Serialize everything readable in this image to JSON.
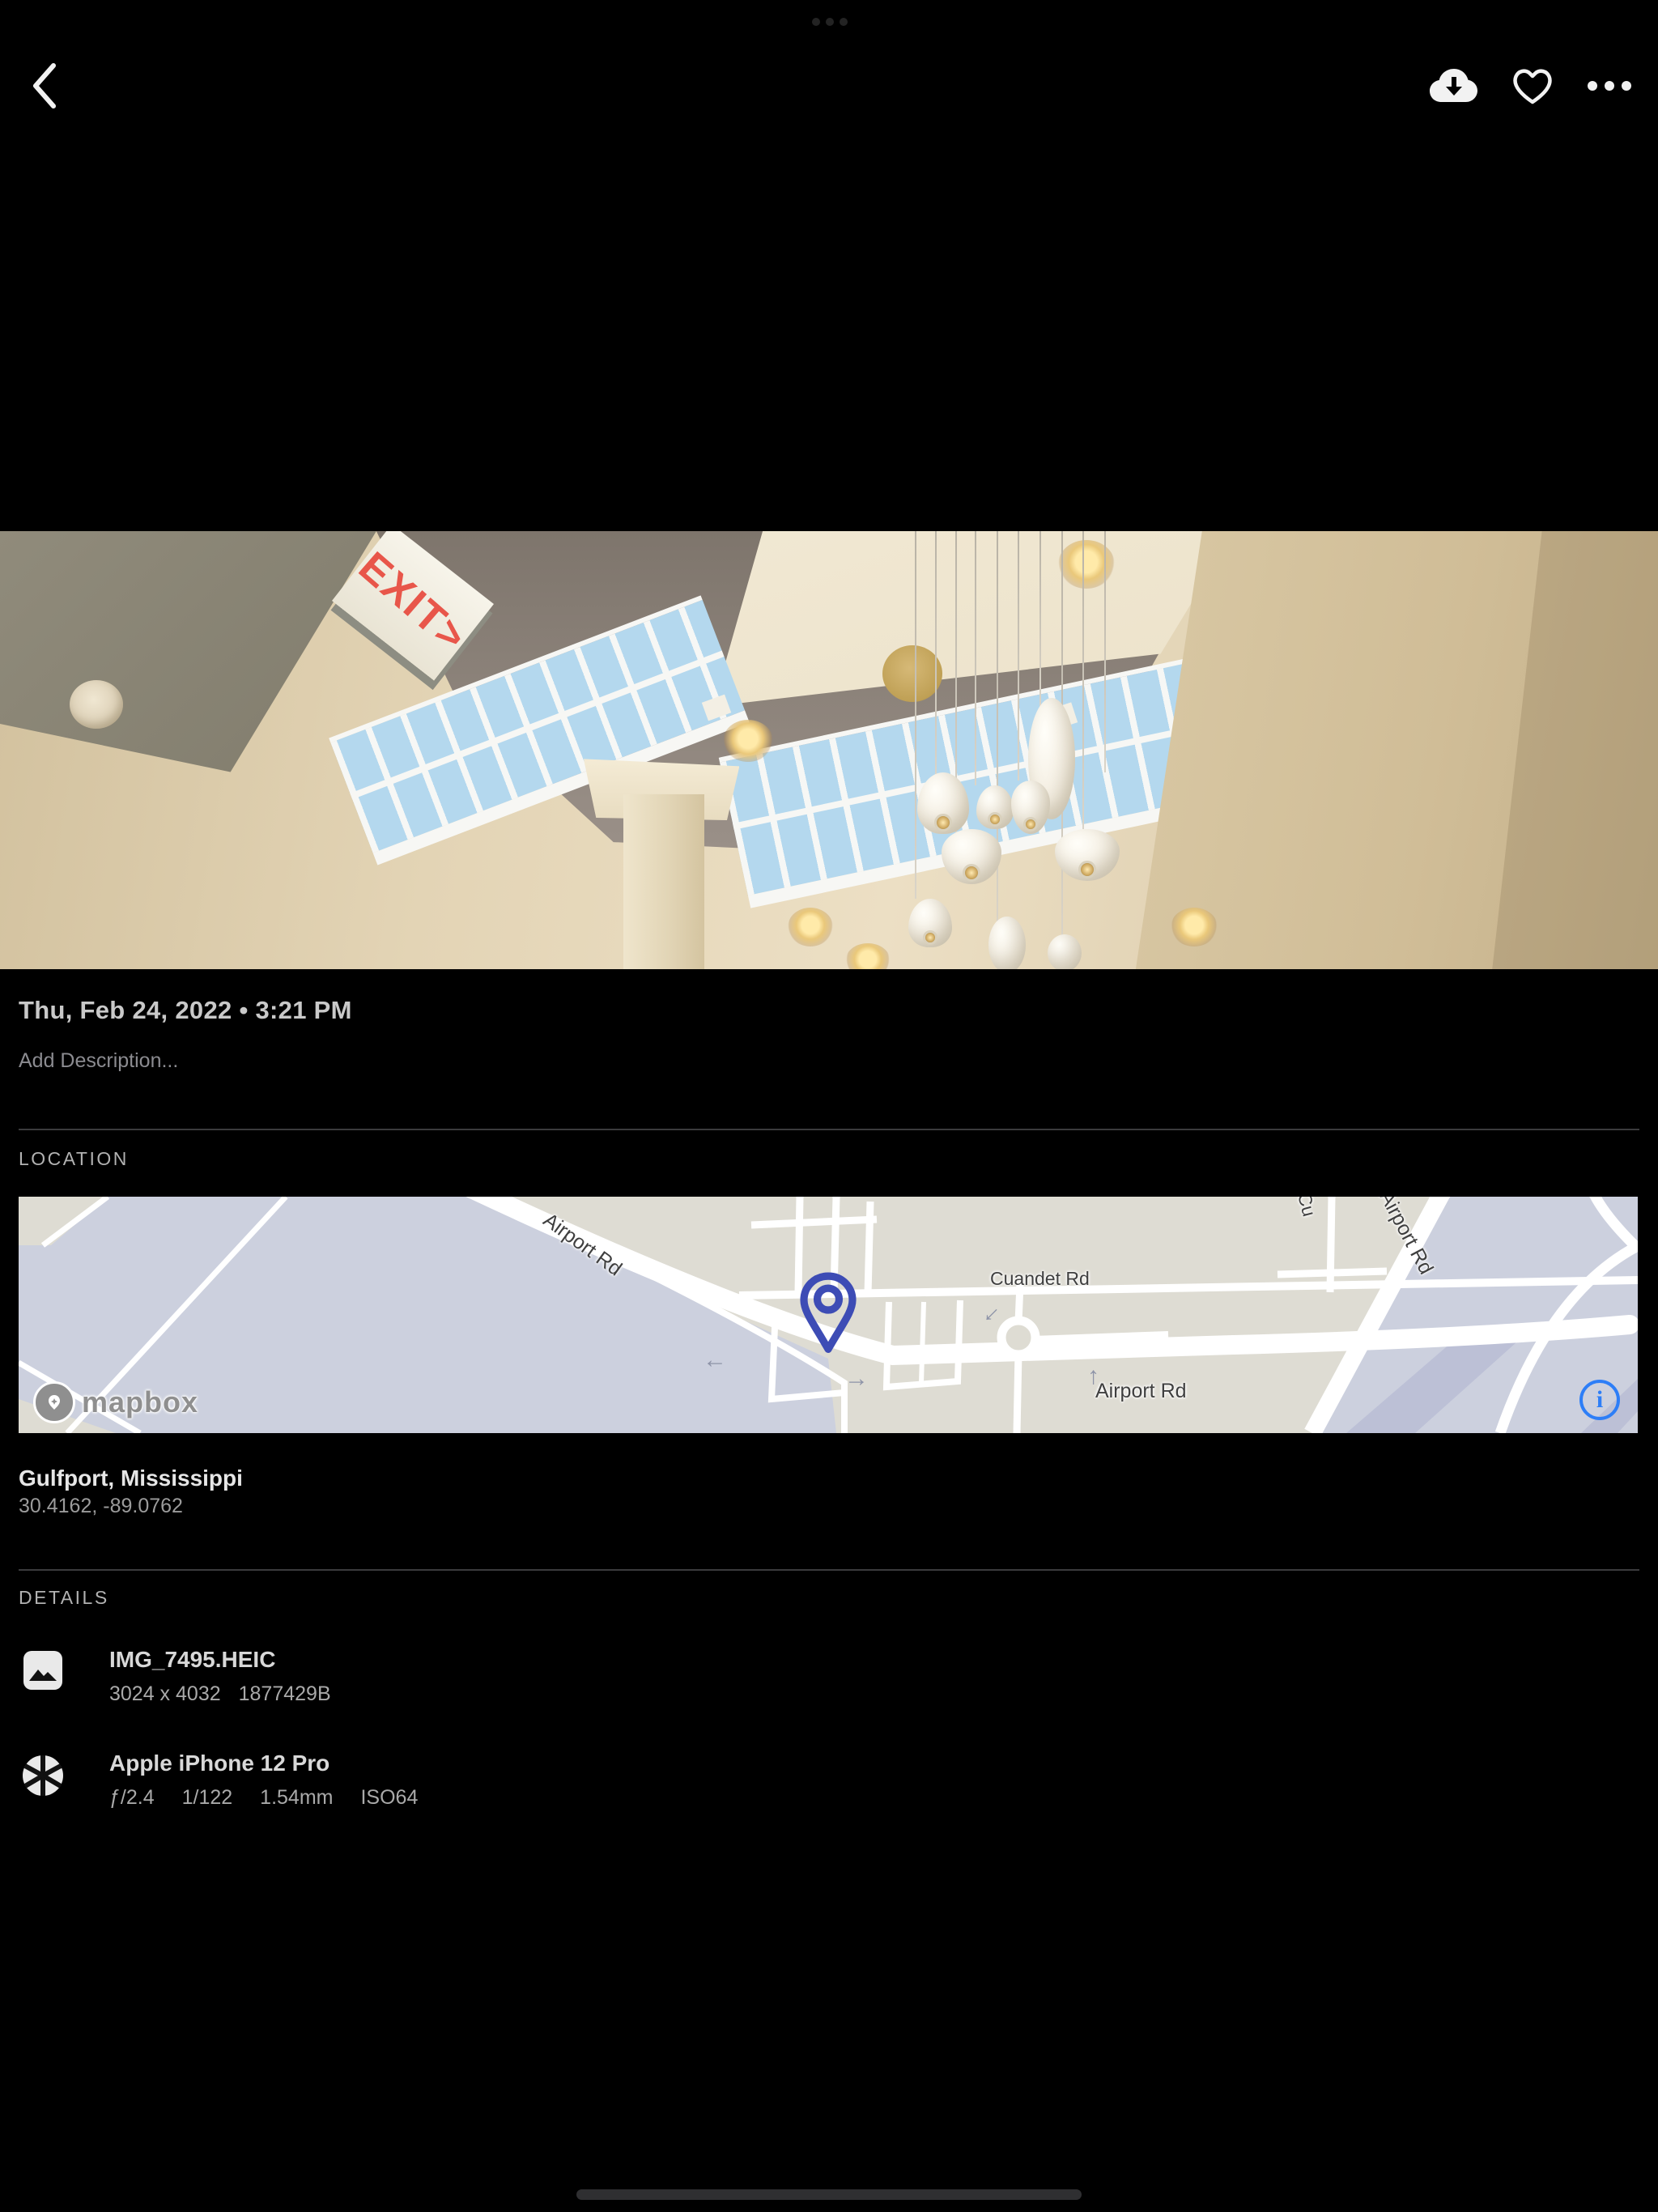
{
  "status_bar": {
    "multitask_indicator_dots": 3
  },
  "toolbar": {
    "back_icon": "chevron-left",
    "download_icon": "cloud-download",
    "favorite_icon": "heart-outline",
    "more_icon": "ellipsis"
  },
  "photo": {
    "exit_sign": "EXIT>"
  },
  "info": {
    "datetime": "Thu, Feb 24, 2022 • 3:21 PM",
    "description_placeholder": "Add Description...",
    "location": {
      "section_label": "LOCATION",
      "place": "Gulfport, Mississippi",
      "coordinates": "30.4162, -89.0762",
      "map": {
        "attribution_logo": "mapbox",
        "info_icon": "i",
        "labels": {
          "airport_rd_diagonal": "Airport Rd",
          "cuandet_rd": "Cuandet Rd",
          "airport_rd_bottom": "Airport Rd",
          "airport_rd_upper_right": "Airport Rd",
          "cross_street_partial": "Cu"
        },
        "colors": {
          "land_light": "#ccd0de",
          "land_beige": "#dedcd3",
          "pin": "#3d4cb5",
          "info_blue": "#2d7ef7"
        }
      }
    },
    "details": {
      "section_label": "DETAILS",
      "file": {
        "name": "IMG_7495.HEIC",
        "dimensions": "3024 x 4032",
        "size": "1877429B"
      },
      "camera": {
        "name": "Apple iPhone 12 Pro",
        "aperture": "ƒ/2.4",
        "shutter": "1/122",
        "focal_length": "1.54mm",
        "iso": "ISO64"
      }
    }
  }
}
